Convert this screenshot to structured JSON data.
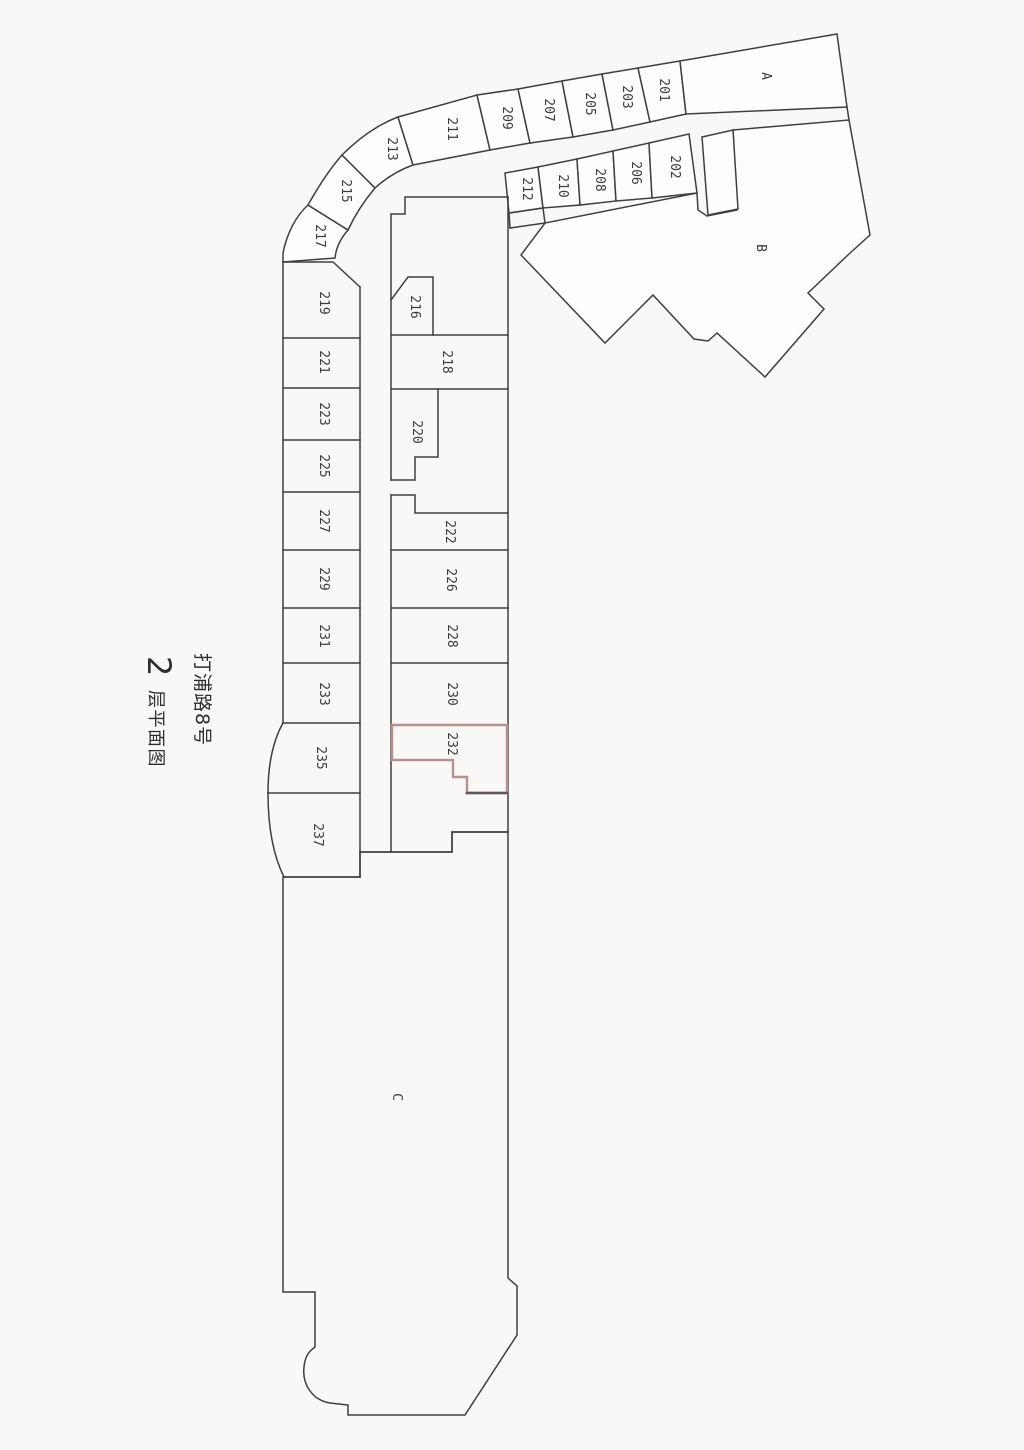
{
  "title": {
    "building": "打浦路8号",
    "floor_number": "2",
    "floor_suffix": "层平面图"
  },
  "sections": {
    "a": "A",
    "b": "B",
    "c": "C"
  },
  "outer_band": [
    "217",
    "215",
    "213",
    "211",
    "209",
    "207",
    "205",
    "203",
    "201"
  ],
  "inner_band": [
    "212",
    "210",
    "208",
    "206",
    "202"
  ],
  "left_column": [
    "219",
    "221",
    "223",
    "225",
    "227",
    "229",
    "231",
    "233",
    "235",
    "237"
  ],
  "middle_column": [
    "216",
    "218",
    "220",
    "222",
    "226",
    "228",
    "230",
    "232"
  ],
  "highlight": {
    "room": "232",
    "outline_color": "#b98f8f",
    "outline_dark_color": "#60575c"
  },
  "colors": {
    "background": "#f9f8f6",
    "wall": "#3f3f3f",
    "label": "#3c3c3c"
  }
}
